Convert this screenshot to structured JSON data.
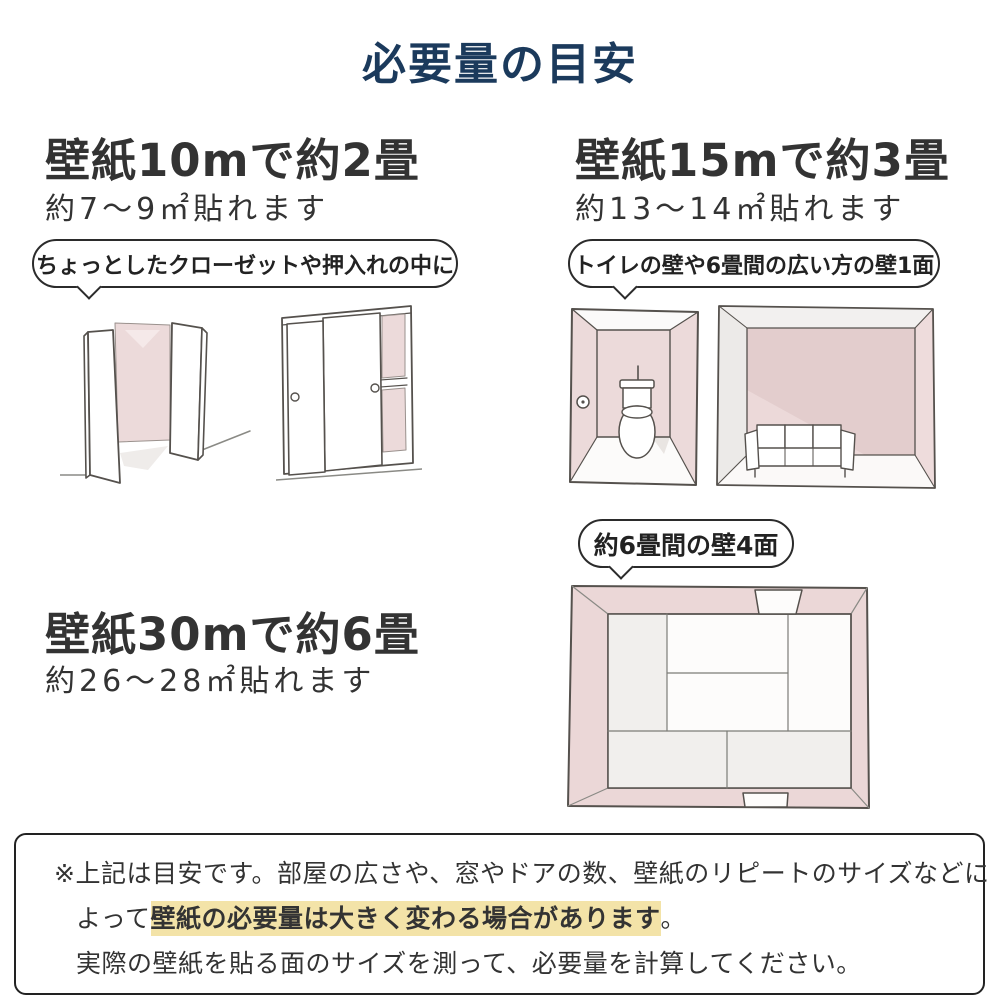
{
  "page": {
    "title": "必要量の目安"
  },
  "sections": [
    {
      "id": "wallpaper-10m",
      "heading": "壁紙10mで約2畳",
      "subtext": "約7〜9㎡貼れます",
      "bubble": "ちょっとしたクローゼットや押入れの中に"
    },
    {
      "id": "wallpaper-15m",
      "heading": "壁紙15mで約3畳",
      "subtext": "約13〜14㎡貼れます",
      "bubble": "トイレの壁や6畳間の広い方の壁1面"
    },
    {
      "id": "wallpaper-30m",
      "heading": "壁紙30mで約6畳",
      "subtext": "約26〜28㎡貼れます",
      "bubble": "約6畳間の壁4面"
    }
  ],
  "note": {
    "line1": "※上記は目安です。部屋の広さや、窓やドアの数、壁紙のリピートのサイズなどに",
    "line2_prefix": "よって",
    "line2_highlight": "壁紙の必要量は大きく変わる場合があります",
    "line2_suffix": "。",
    "line3": "実際の壁紙を貼る面のサイズを測って、必要量を計算してください。"
  },
  "illustrations": {
    "closet_open": "closet-open-doors-illustration",
    "closet_sliding": "closet-sliding-doors-illustration",
    "toilet": "toilet-room-illustration",
    "sofa": "sofa-room-illustration",
    "tatami": "tatami-room-top-view-illustration"
  },
  "colors": {
    "title_navy": "#1b3a5c",
    "text_dark": "#333333",
    "wall_pink": "#ecdada",
    "wall_pink_dark": "#e3cdcd",
    "wall_gray": "#eceae8",
    "highlight_yellow": "#f3e3a8",
    "sketch_stroke": "#55514d"
  }
}
